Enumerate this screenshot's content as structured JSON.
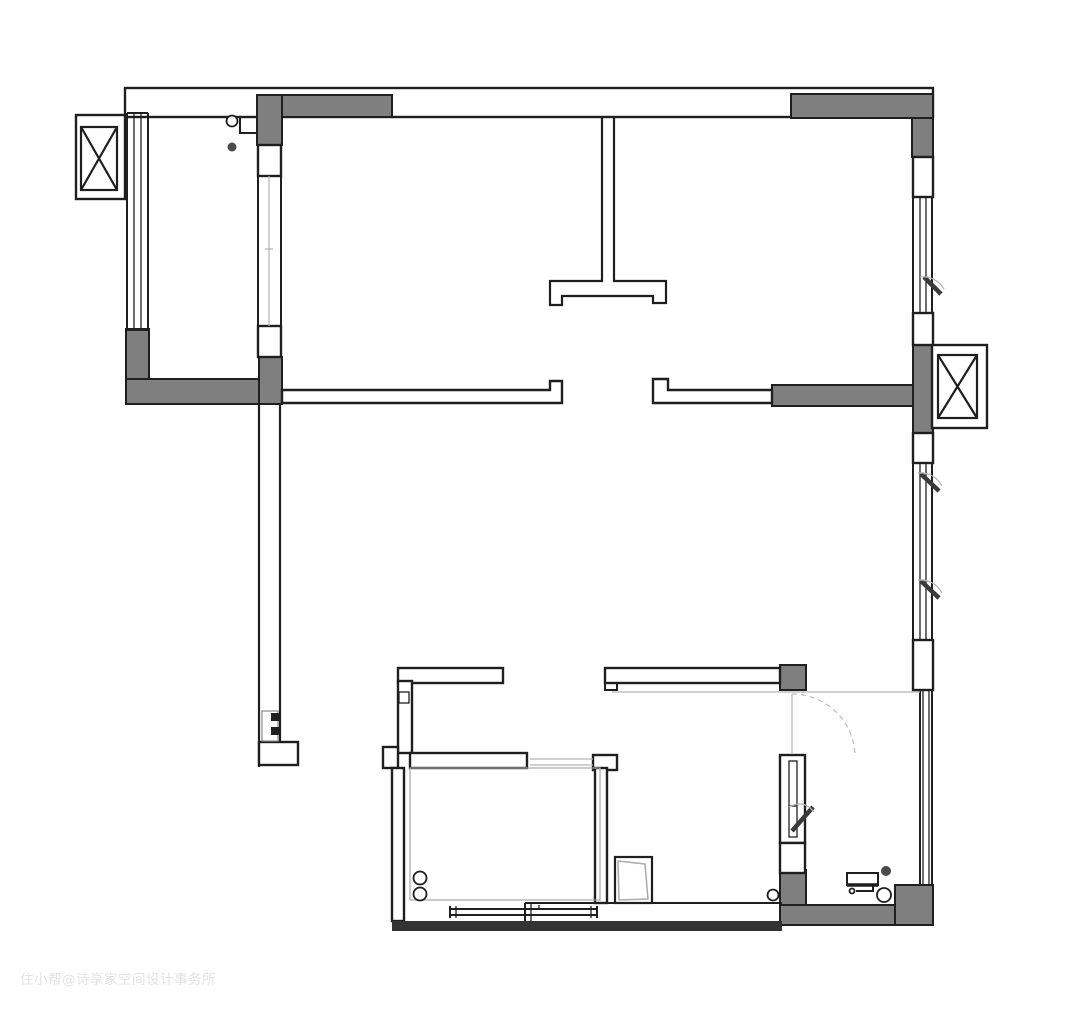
{
  "watermark": {
    "text": "住小帮@诗享家空间设计事务所"
  },
  "colors": {
    "background": "#ffffff",
    "wall_fill": "#7f7f7f",
    "line": "#1f1f1f",
    "light_line": "#b3b3b3",
    "dashed_arc": "#bbbbbb",
    "dark_band": "#333333",
    "watermark": "#e2e2e2"
  },
  "symbols": {
    "elevator_shaft": "crossed-box-symbol",
    "window": "multi-line-window-symbol",
    "casement_window": "diagonal-bar-with-arc-symbol",
    "door_swing": "dashed-quarter-arc-symbol",
    "stove_burners": "double-circle-symbol",
    "floor_drain": "circle-symbol",
    "washbasin": "rect-with-trap-symbol"
  }
}
